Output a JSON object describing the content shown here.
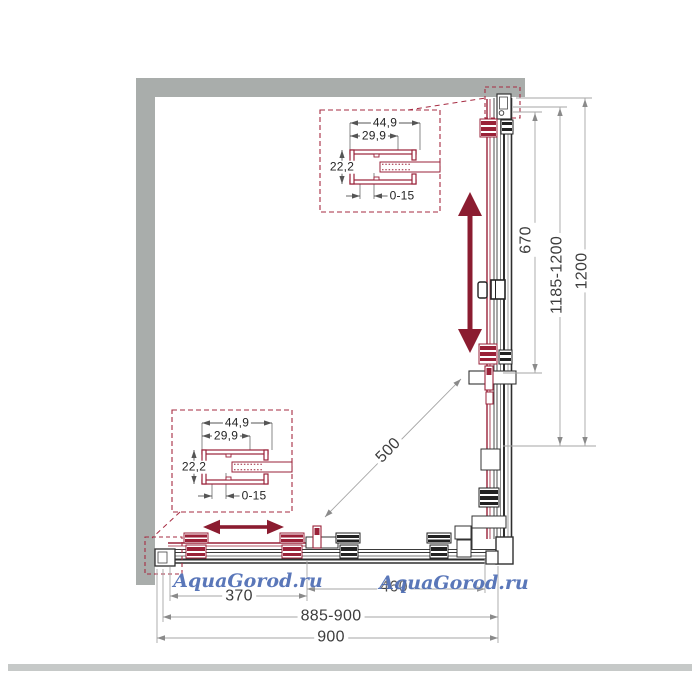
{
  "watermark": {
    "text": "AquaGorod.ru",
    "color": "#4d6cb4"
  },
  "colors": {
    "wall": "#a9adab",
    "accent_red": "#9a2138",
    "movement_arrow": "#8b1c30",
    "dimension_line": "#a6a6a6",
    "dimension_text": "#3d3d3d",
    "callout_border": "#a62b42"
  },
  "profile_callout": {
    "outer_width": "44,9",
    "inner_width": "29,9",
    "height": "22,2",
    "adjustment_range": "0-15"
  },
  "dimensions": {
    "side_door_width": "670",
    "side_adjustable_depth": "1185-1200",
    "side_total_depth": "1200",
    "diagonal_entry": "500",
    "front_left_panel": "370",
    "front_right_panel": "460",
    "front_adjustable_width": "885-900",
    "front_total_width": "900"
  }
}
